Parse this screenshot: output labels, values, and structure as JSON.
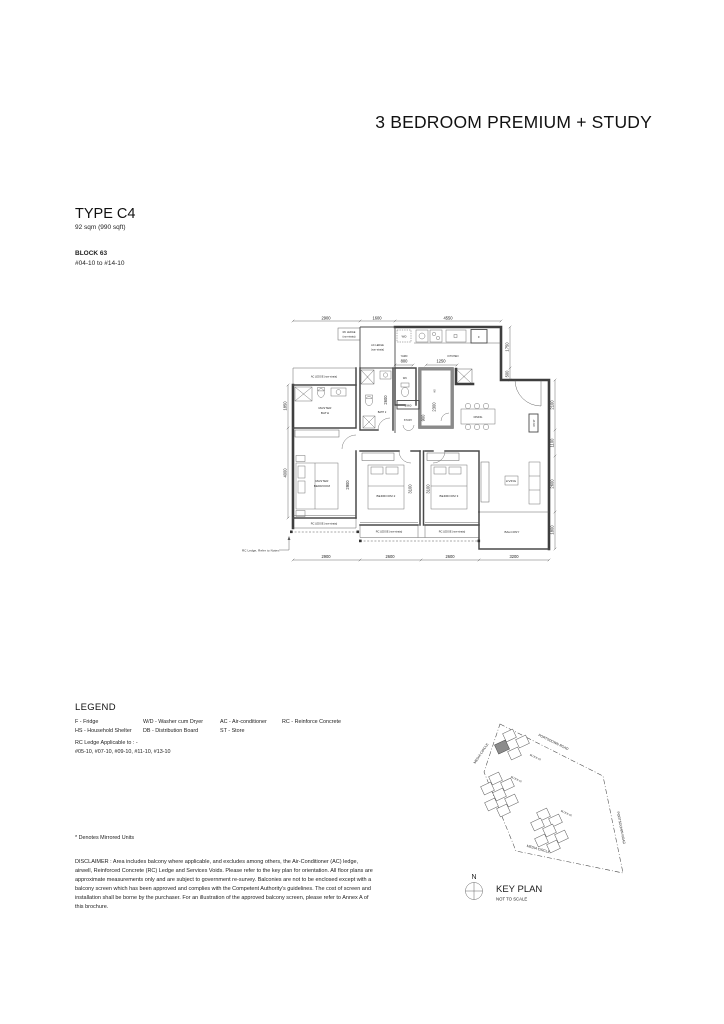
{
  "header": {
    "category": "3 BEDROOM PREMIUM + STUDY",
    "type": "TYPE C4",
    "area": "92 sqm (990 sqft)",
    "block": "BLOCK 63",
    "units": "#04-10 to #14-10"
  },
  "plan": {
    "dims": {
      "top": [
        "2900",
        "1600",
        "4550"
      ],
      "right": [
        "1750",
        "500",
        "2100",
        "1100",
        "2600",
        "1800"
      ],
      "left": [
        "1850",
        "4000"
      ],
      "bottom": [
        "2900",
        "2600",
        "2600",
        "3200"
      ],
      "yard": "800",
      "kitchen": "1250",
      "hs": "2300",
      "bath2": "2600",
      "desk": "1960",
      "study_w": "900",
      "master": "2900",
      "bed2": "3100",
      "bed3": "3100"
    },
    "labels": {
      "rc_ledge_1": "RC LEDGE",
      "rc_ledge_2": "(non-strata)",
      "ac_ledge_1": "AC LEDGE",
      "ac_ledge_2": "(non-strata)",
      "ac_ledge_strip": "AC LEDGE (non-strata)",
      "rc_strip": "RC LEDGE (non-strata)",
      "wd": "W/D",
      "fridge": "F",
      "yard": "YARD",
      "kitchen": "KITCHEN",
      "wc": "WC",
      "hs": "HS",
      "master_bath_1": "MASTER",
      "master_bath_2": "BATH",
      "bath2": "BATH 2",
      "study": "STUDY",
      "dining": "DINING",
      "dbst": "DB ST",
      "master_bed_1": "MASTER",
      "master_bed_2": "BEDROOM",
      "bed2": "BEDROOM 2",
      "bed3": "BEDROOM 3",
      "living": "LIVING",
      "balcony": "BALCONY",
      "note": "RC Ledge, Refer to Notes."
    }
  },
  "legend": {
    "title": "LEGEND",
    "col1": [
      "F - Fridge",
      "HS - Household Shelter"
    ],
    "col2": [
      "W/D - Washer cum Dryer",
      "DB - Distribution Board"
    ],
    "col3": [
      "AC - Air-conditioner",
      "ST - Store"
    ],
    "col4": [
      "RC - Reinforce Concrete"
    ],
    "rc_applicable_1": "RC Ledge Applicable to : -",
    "rc_applicable_2": "#05-10, #07-10, #09-10, #11-10, #13-10",
    "mirrored": "* Denotes Mirrored Units"
  },
  "disclaimer": "DISCLAIMER : Area includes balcony where applicable, and excludes among others, the Air-Conditioner (AC) ledge, airwell, Reinforced Concrete (RC) Ledge and Services Voids. Please refer to the key plan for orientation. All floor plans are approximate measurements only and are subject to government re-survey. Balconies are not to be enclosed except with a balcony screen which has been approved and complies with the Competent Authority's guidelines. The cost of screen and installation shall be borne by the purchaser. For an illustration of the approved balcony screen, please refer to Annex A of this brochure.",
  "keyplan": {
    "title": "KEY PLAN",
    "scale": "NOT TO SCALE",
    "north": "N",
    "road_top": "PORTSDOWN ROAD",
    "road_right": "PORTSDOWN ROAD",
    "road_left": "MEDIA CIRCLE",
    "road_bottom": "MEDIA CIRCLE",
    "block_top": "BLOCK 63",
    "block_mid": "BLOCK 61",
    "block_bottom": "BLOCK 65"
  }
}
